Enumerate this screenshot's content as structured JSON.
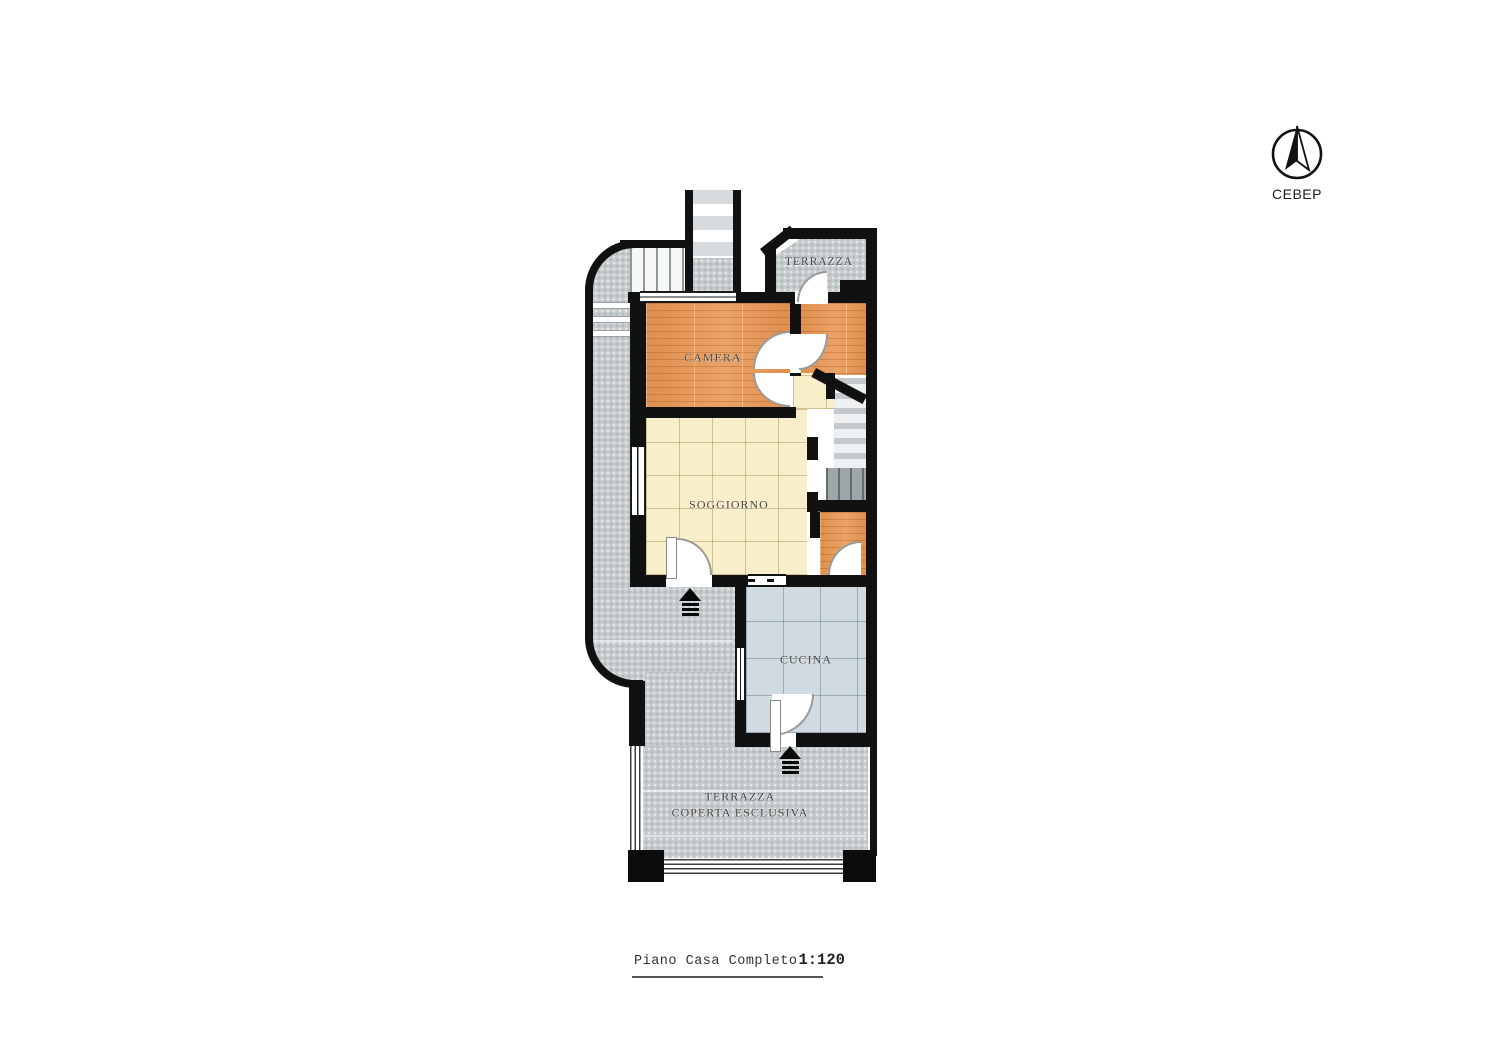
{
  "north_indicator": {
    "label": "СЕВЕР",
    "icon": "north-arrow-icon"
  },
  "rooms": {
    "terrazza_top": {
      "label": "TERRAZZA"
    },
    "camera": {
      "label": "CAMERA"
    },
    "soggiorno": {
      "label": "SOGGIORNO"
    },
    "cucina": {
      "label": "CUCINA"
    },
    "terrazza_coperta": {
      "label_line1": "TERRAZZA",
      "label_line2": "COPERTA ESCLUSIVA"
    }
  },
  "title_block": {
    "title": "Piano Casa Completo",
    "scale": "1:120"
  },
  "icons": {
    "entrance": "entrance-arrow-icon",
    "north": "north-arrow-icon"
  },
  "colors": {
    "wall": "#111111",
    "wood_floor": "#e2955a",
    "cream_tile": "#f8eeca",
    "kitchen_tile": "#cfdae1",
    "terrace": "#c6cccd",
    "stair_dark": "#9ea6aa",
    "background": "#ffffff"
  }
}
